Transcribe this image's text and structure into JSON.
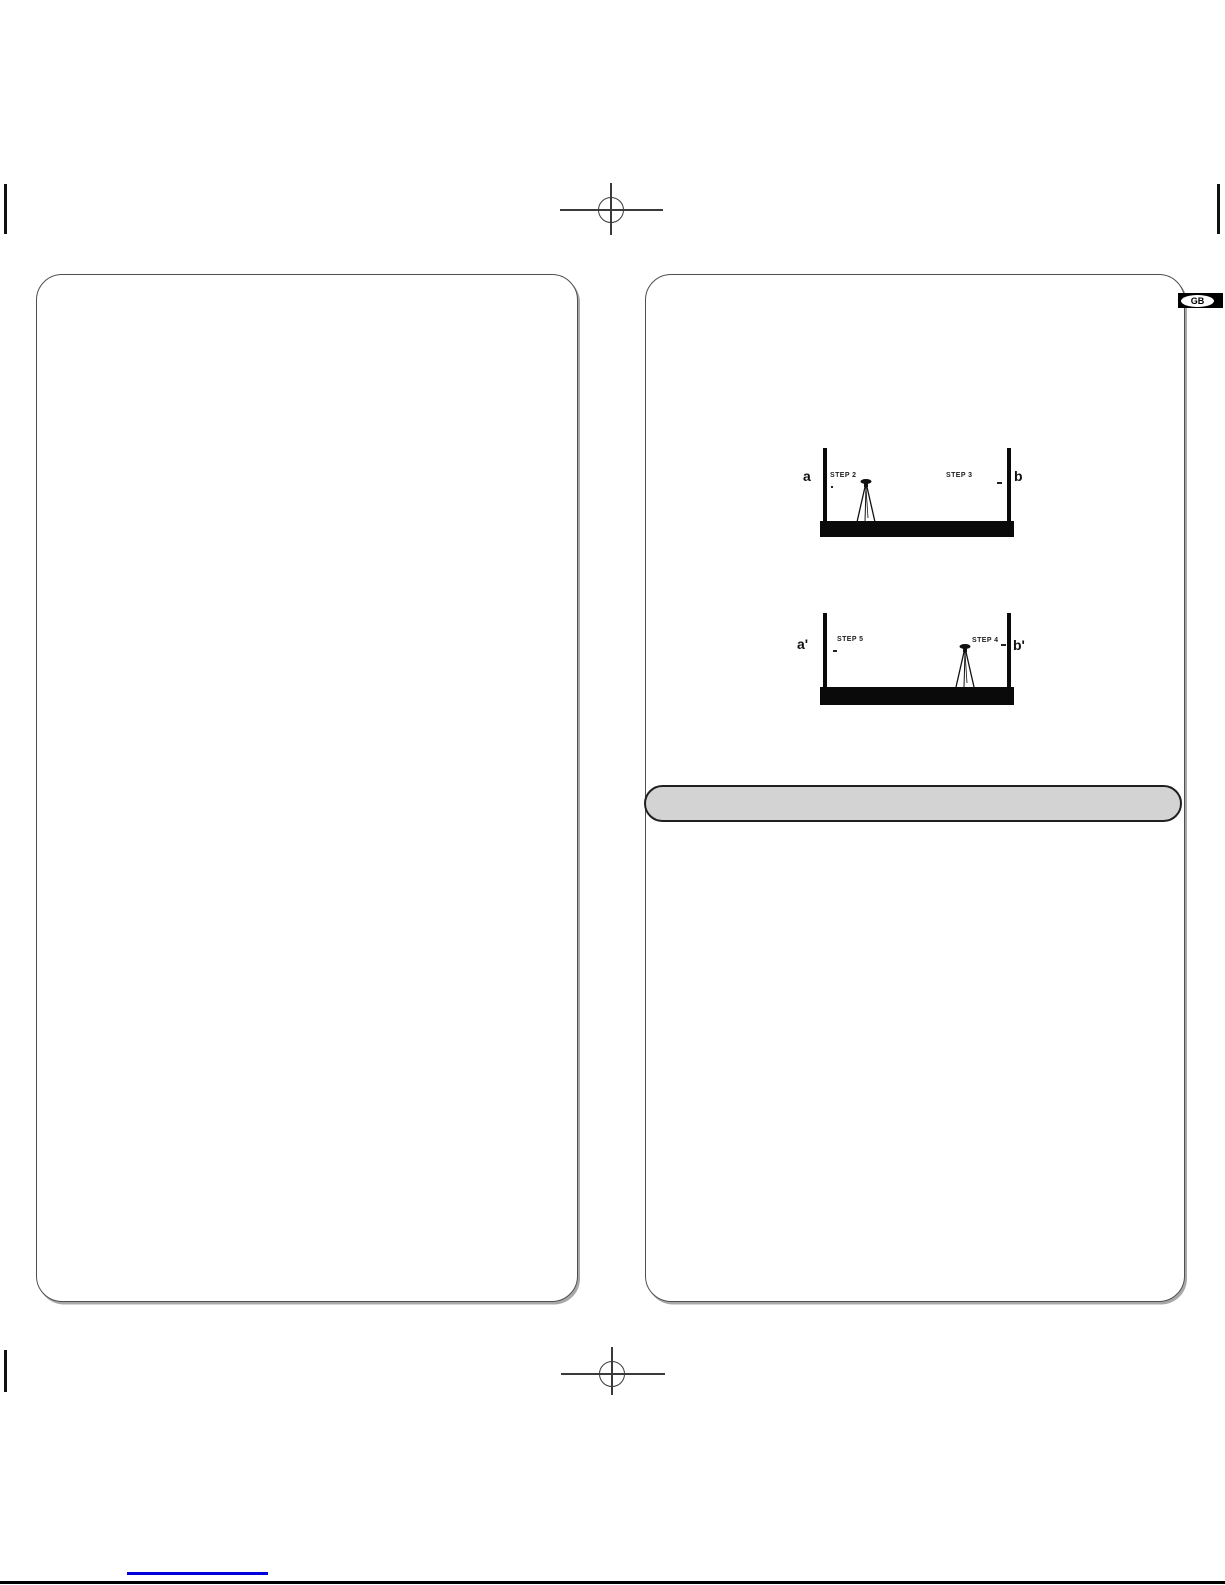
{
  "badge": {
    "label": "GB"
  },
  "diagrams": {
    "first": {
      "left_wall_label": "a",
      "right_wall_label": "b",
      "left_step_label": "STEP 2",
      "right_step_label": "STEP 3"
    },
    "second": {
      "left_wall_label": "a'",
      "right_wall_label": "b'",
      "left_step_label": "STEP 5",
      "right_step_label": "STEP 4"
    }
  },
  "colors": {
    "link_underline_blue": "#0000dd",
    "section_bar_fill": "#d3d3d3",
    "panel_border": "#4f4f4f",
    "floor_black": "#0a0a0a"
  },
  "icons": {
    "registration_mark": "registration-crosshair-icon",
    "tripod": "tripod-level-icon",
    "edge_tick": "crop-tick-icon"
  }
}
